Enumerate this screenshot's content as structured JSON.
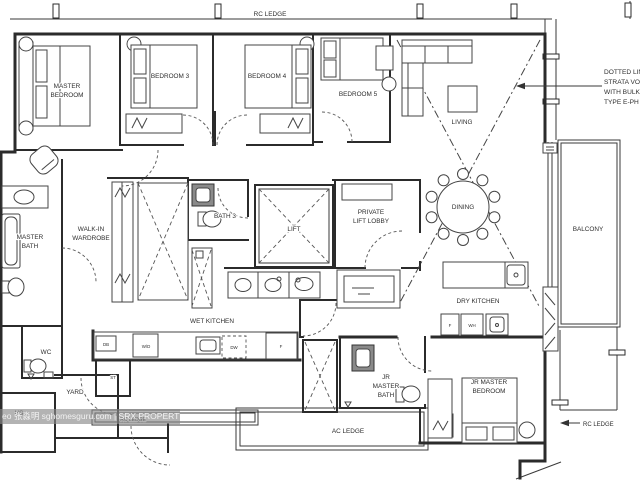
{
  "labels": {
    "rc_ledge_top": "RC LEDGE",
    "master_bedroom": [
      "MASTER",
      "BEDROOM"
    ],
    "bedroom_3": "BEDROOM 3",
    "bedroom_4": "BEDROOM 4",
    "bedroom_5": "BEDROOM 5",
    "living": "LIVING",
    "dining": "DINING",
    "balcony": "BALCONY",
    "strata_note": [
      "DOTTED LIN",
      "STRATA VO",
      "WITH BULKH",
      "TYPE E-PH"
    ],
    "walk_in_wardrobe": [
      "WALK-IN",
      "WARDROBE"
    ],
    "master_bath": [
      "MASTER",
      "BATH"
    ],
    "bath_3": "BATH 3",
    "lift": "LIFT",
    "private_lift_lobby": [
      "PRIVATE",
      "LIFT LOBBY"
    ],
    "wet_kitchen": "WET KITCHEN",
    "dry_kitchen": "DRY KITCHEN",
    "wc": "WC",
    "yard": "YARD",
    "hs": "HS",
    "db": "DB",
    "wd": "W/D",
    "st": "ST",
    "dw": "DW",
    "fridge_wet": "F",
    "fridge_dry": "F",
    "wh": "WH",
    "jr_master_bath": [
      "JR",
      "MASTER",
      "BATH"
    ],
    "jr_master_bedroom": [
      "JR MASTER",
      "BEDROOM"
    ],
    "ac_ledge": "AC LEDGE",
    "rc_ledge_right": "RC LEDGE",
    "rc_ledge_bottom": "RC LEDGE"
  },
  "watermark": "eo 张淼明 sghomesguru.com | SRX PROPERTY",
  "colors": {
    "line": "#2b2b2b",
    "text": "#2e2e2e",
    "watermark_bg": "#8a8a8a"
  }
}
